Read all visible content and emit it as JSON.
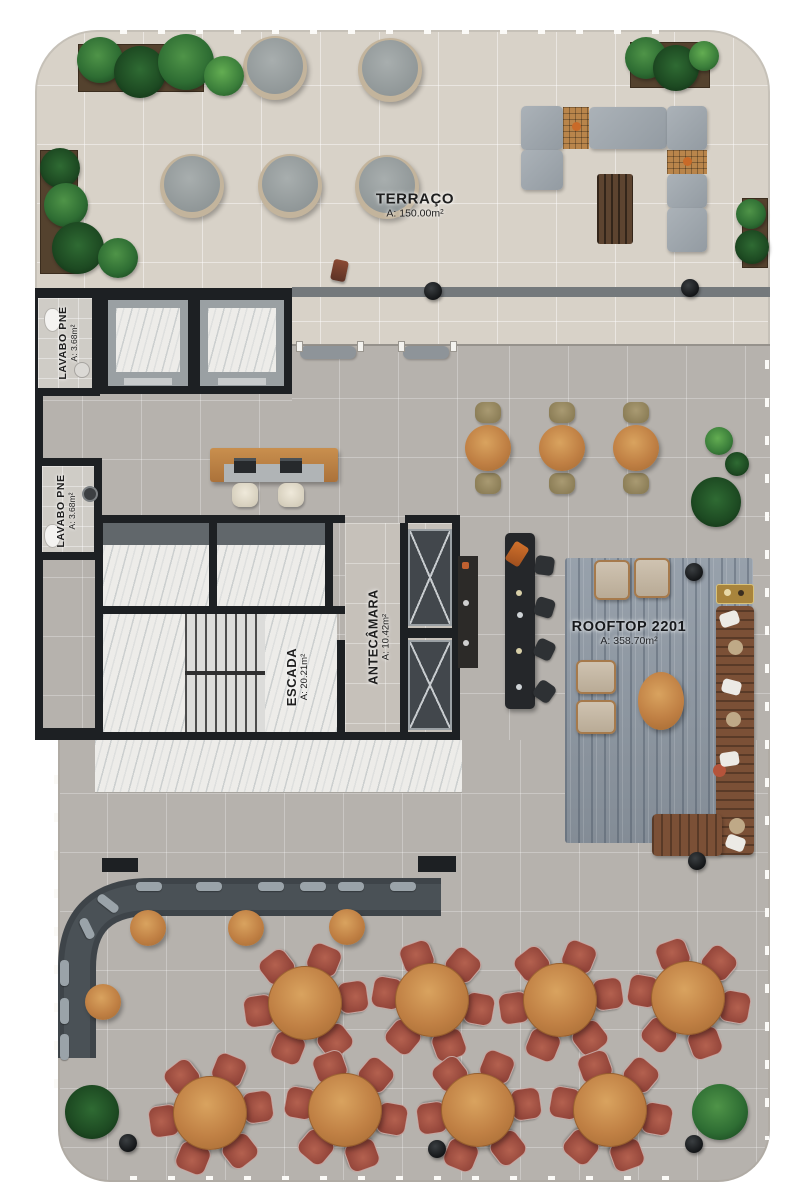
{
  "plan": {
    "type": "rooftop-floor-plan",
    "unit": "2201"
  },
  "labels": {
    "terraco": {
      "name": "TERRAÇO",
      "area": "A: 150.00m²"
    },
    "lavabo_pne_1": {
      "name": "LAVABO PNE",
      "area": "A: 3.68m²"
    },
    "lavabo_pne_2": {
      "name": "LAVABO PNE",
      "area": "A: 3.68m²"
    },
    "escada": {
      "name": "ESCADA",
      "area": "A: 20.21m²"
    },
    "antecamara": {
      "name": "ANTECÂMARA",
      "area": "A: 10.42m²"
    },
    "rooftop": {
      "name": "ROOFTOP 2201",
      "area": "A: 358.70m²"
    }
  },
  "colors": {
    "wall": "#1d2023",
    "terrace_tile": "#d8d2c8",
    "deck_tile": "#b6b2ad",
    "marble": "#edece9",
    "rug": "#929ca7",
    "wood": "#c08044",
    "dining_chair": "#9c4f43",
    "banquette": "#3e4449",
    "lounge_cushion": "#a3aab0",
    "outdoor_sofa": "#7b5036",
    "plant": "#2e6d33"
  }
}
